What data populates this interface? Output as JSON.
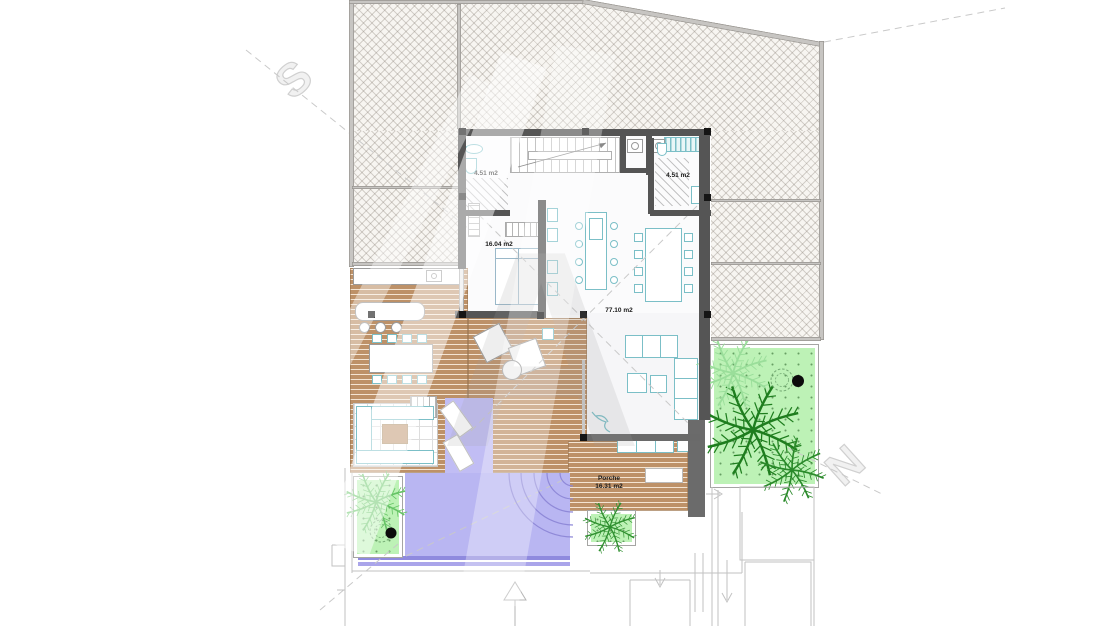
{
  "plan": {
    "labels": {
      "bath_left_area": "4.51 m2",
      "bath_right_area": "4.51 m2",
      "bedroom_area": "16.04 m2",
      "living_area": "77.10 m2",
      "porch_name": "Porche",
      "porch_area": "16.31 m2"
    },
    "watermark": {
      "letter_s": "S",
      "letter_n": "N",
      "letter_a": "A"
    },
    "colors": {
      "deck_wood": "#bd9168",
      "pool_water": "#b9b6f2",
      "pool_edge": "#8f8ade",
      "garden_green": "#bdf2b6",
      "palm_green": "#1e7d1e",
      "wall_dark": "#555555",
      "wall_light": "#c7c5c2",
      "furniture_teal": "#7bbfc7",
      "hatch_background": "#f7f5f1"
    }
  }
}
